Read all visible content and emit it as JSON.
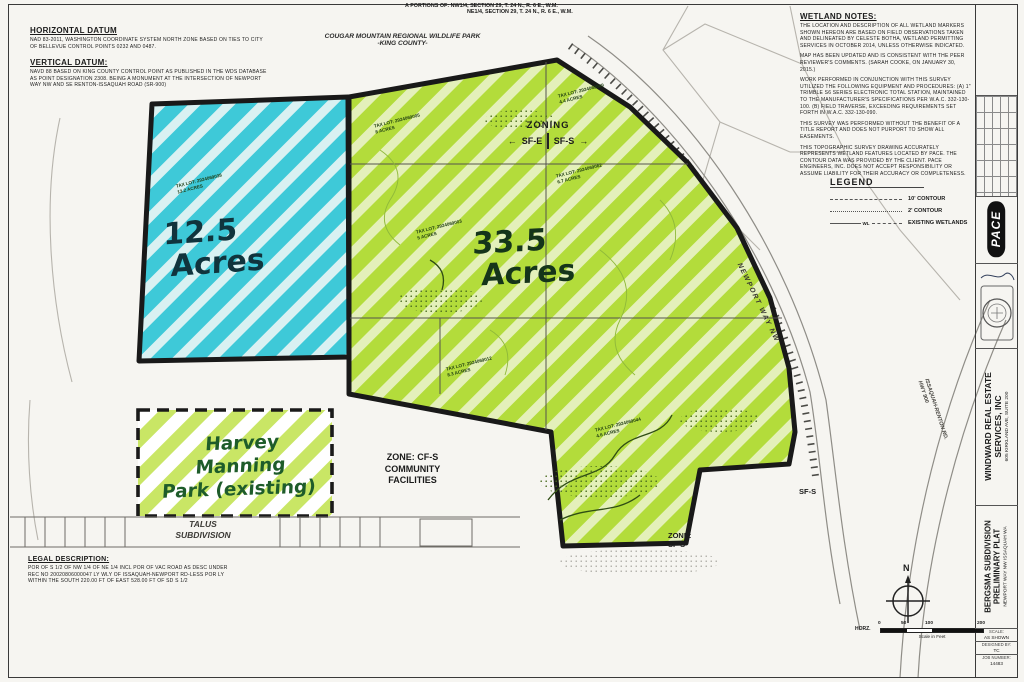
{
  "colors": {
    "highlight_blue": "#3ec9d8",
    "highlight_green": "#b3dc3b",
    "park_stripe": "#c9e665",
    "boundary": "#191919"
  },
  "header": {
    "portions_line1": "A PORTIONS OF:  NW1/4, SECTION 29, T. 24 N., R. 6 E., W.M.",
    "portions_line2": "NE1/4, SECTION 29, T. 24 N., R. 6 E., W.M.",
    "cougar_line1": "COUGAR MOUNTAIN REGIONAL WILDLIFE PARK",
    "cougar_line2": "-KING COUNTY-"
  },
  "datum": {
    "h_title": "HORIZONTAL DATUM",
    "h_body": "NAD 83-2011, WASHINGTON COORDINATE SYSTEM NORTH ZONE BASED ON TIES TO CITY OF BELLEVUE CONTROL POINTS 0232 AND 0487.",
    "v_title": "VERTICAL DATUM:",
    "v_body": "NAVD 88 BASED ON KING COUNTY CONTROL POINT AS PUBLISHED IN THE WDS DATABASE AS POINT DESIGNATION 2308.  BEING A MONUMENT AT THE INTERSECTION OF NEWPORT WAY NW AND SE RENTON-ISSAQUAH ROAD (SR-900)"
  },
  "wetland_notes": {
    "title": "WETLAND NOTES:",
    "paragraphs": [
      "THE LOCATION AND DESCRIPTION OF ALL WETLAND MARKERS SHOWN HEREON ARE BASED ON FIELD OBSERVATIONS TAKEN AND DELINEATED BY CELESTE BOTHA, WETLAND PERMITTING SERVICES IN OCTOBER 2014, UNLESS OTHERWISE INDICATED.",
      "MAP HAS BEEN UPDATED AND IS CONSISTENT WITH THE PEER REVIEWER'S COMMENTS. (SARAH COOKE, ON JANUARY 30, 2015.)",
      "WORK PERFORMED IN CONJUNCTION WITH THIS SURVEY UTILIZED THE FOLLOWING EQUIPMENT AND PROCEDURES: (A) 1\" TRIMBLE S6 SERIES ELECTRONIC TOTAL STATION, MAINTAINED TO THE MANUFACTURER'S SPECIFICATIONS PER W.A.C. 332-130-100.  (B) FIELD TRAVERSE, EXCEEDING REQUIREMENTS SET FORTH IN W.A.C. 332-130-090.",
      "THIS SURVEY WAS PERFORMED WITHOUT THE BENEFIT OF A TITLE REPORT AND DOES NOT PURPORT TO SHOW ALL EASEMENTS.",
      "THIS TOPOGRAPHIC SURVEY DRAWING ACCURATELY REPRESENTS WETLAND FEATURES LOCATED BY PACE.  THE CONTOUR DATA WAS PROVIDED BY THE CLIENT.  PACE ENGINEERS, INC. DOES NOT ACCEPT RESPONSIBILITY OR ASSUME LIABILITY FOR THEIR ACCURACY OR COMPLETENESS."
    ]
  },
  "legend": {
    "title": "LEGEND",
    "items": [
      {
        "label": "10' CONTOUR"
      },
      {
        "label": "2' CONTOUR"
      },
      {
        "label": "EXISTING WETLANDS",
        "mid": "WL"
      }
    ]
  },
  "zoning": {
    "title": "ZONING",
    "left": "SF-E",
    "right": "SF-S",
    "arrow_left": "←",
    "arrow_right": "→"
  },
  "areas": {
    "blue_line1": "12.5",
    "blue_line2": "Acres",
    "green_line1": "33.5",
    "green_line2": "Acres",
    "park_line1": "Harvey Manning",
    "park_line2": "Park (existing)"
  },
  "zones": {
    "cfs_line1": "ZONE: CF-S",
    "cfs_line2": "COMMUNITY",
    "cfs_line3": "FACILITIES",
    "talus_line1": "TALUS",
    "talus_line2": "SUBDIVISION",
    "sfs_bottom_line1": "ZONE:",
    "sfs_bottom_line2": "SF-S",
    "sfs_right": "SF-S"
  },
  "roads": {
    "newport": "NEWPORT WAY NW",
    "issaquah_line1": "ISSAQUAH-RENTON RD.",
    "issaquah_line2": "HWY 900"
  },
  "tax_lots": [
    {
      "line1": "TAX LOT: 2924069038",
      "line2": "13.2 ACRES"
    },
    {
      "line1": "TAX LOT: 2924069005",
      "line2": "8 ACRES"
    },
    {
      "line1": "TAX LOT: 2924069049",
      "line2": "4.4 ACRES"
    },
    {
      "line1": "TAX LOT: 2924069062",
      "line2": "6.7 ACRES"
    },
    {
      "line1": "TAX LOT: 2924069003",
      "line2": "5 ACRES"
    },
    {
      "line1": "TAX LOT: 2924069012",
      "line2": "8.3 ACRES"
    },
    {
      "line1": "TAX LOT: 2924069044",
      "line2": "4.6 ACRES"
    }
  ],
  "legal": {
    "title": "LEGAL DESCRIPTION:",
    "body": "POR OF S 1/2 OF NW 1/4 OF NE 1/4 INCL POR OF VAC ROAD AS DESC UNDER REC NO 20020806000047 LY WLY OF ISSAQUAH-NEWPORT RD-LESS POR LY WITHIN THE SOUTH 220.00 FT OF EAST 528.00 FT OF SD S 1/2"
  },
  "compass": {
    "north": "N"
  },
  "scalebar": {
    "axis": "HORZ.",
    "t0": "0",
    "t50": "50",
    "t100": "100",
    "t200": "200",
    "caption": "Scale in Feet"
  },
  "titleblock": {
    "pace": "PACE",
    "client_line1": "WINDWARD REAL ESTATE",
    "client_line2": "SERVICES, INC",
    "client_line3": "605 KIRKLAND AVE, SUITE 200",
    "project_line1": "BERGSMA SUBDIVISION",
    "project_line2": "PRELIMINARY PLAT",
    "project_line3": "NEWPORT WAY NW  ISSAQUAH WA",
    "info": [
      {
        "label": "SCALE:",
        "value": "AS SHOWN"
      },
      {
        "label": "DESIGNED BY:",
        "value": "TC"
      },
      {
        "label": "JOB NUMBER:",
        "value": "14483"
      }
    ]
  }
}
